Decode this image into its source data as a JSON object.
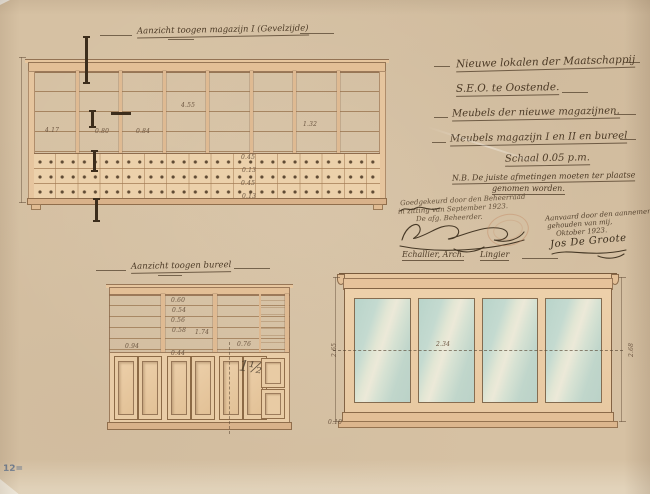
{
  "colors": {
    "paper": "#d6c1a3",
    "ink": "#8a684a",
    "dark_ink": "#3c2d1c",
    "wood_wash": "#e9cda8",
    "glass": "#c6ddd3",
    "pencil_blue": "#5d6e86"
  },
  "sheet": {
    "number": "12="
  },
  "drawings": {
    "top_label": "Aanzicht toogen magazijn I (Gevelzijde)",
    "bureel_label": "Aanzicht toogen bureel"
  },
  "title_block": {
    "line1": "Nieuwe lokalen der Maatschappij",
    "line2": "S.E.O. te Oostende.",
    "line3": "Meubels der nieuwe magazijnen.",
    "line4": "Meubels magazijn I en II en bureel",
    "scale": "Schaal 0.05 p.m.",
    "nb1": "N.B. De juiste afmetingen moeten ter plaatse",
    "nb2": "genomen worden."
  },
  "approval": {
    "line1": "Goedgekeurd door den Beheerraad",
    "line2": "in zitting van September 1923.",
    "line3": "De afg. Beheerder.",
    "architect": "Echallier, Arch.",
    "builder": "Lingier"
  },
  "acceptance": {
    "line1": "Aanvaard door den aannemer",
    "line2": "gehouden van mij,",
    "line3": "Oktober 1923.",
    "signature": "Jos De Groote"
  },
  "dimensions": {
    "top_cabinet": {
      "d1": "4.17",
      "d2": "0.80",
      "d3": "0.84",
      "d4": "4.55",
      "d5": "1.32",
      "stack": [
        "0.45",
        "0.13",
        "0.45",
        "0.13"
      ]
    },
    "bureel": {
      "height": "1.74",
      "left": "0.94",
      "right": "0.76",
      "pencil": "1½",
      "stack": [
        "0.60",
        "0.54",
        "0.56",
        "0.58",
        "0.44"
      ]
    },
    "vitrine": {
      "width": "2.34",
      "left": "2.65",
      "right": "2.68",
      "base": "0.10"
    }
  }
}
